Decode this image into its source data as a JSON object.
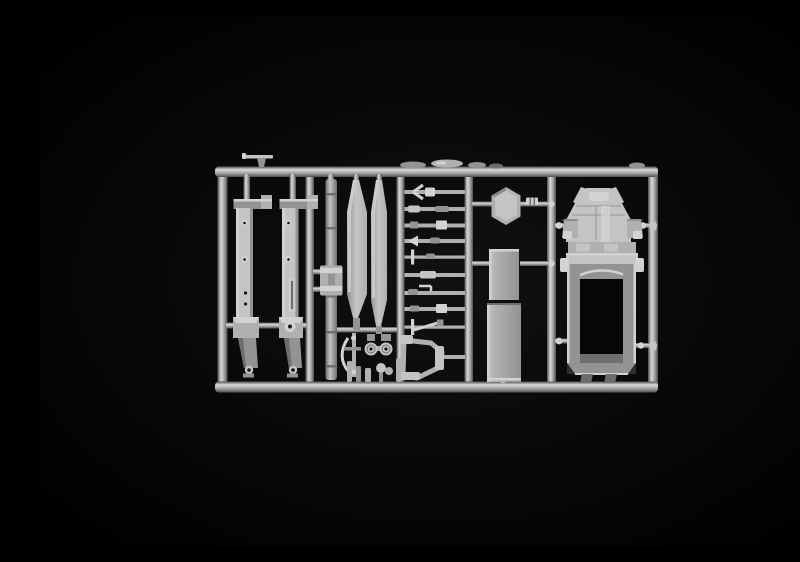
{
  "image": {
    "type": "photograph",
    "subject": "Plastic scale-model kit sprue photographed on a black background",
    "alt_text": "Light grey injection-moulded sprue (parts tree) of an unassembled military truck model kit: two chassis side rails, a segmented drive shaft, two long tapered side blades, a column of small axle and linkage parts, a hexagonal mount, two cargo-bed panels and a truck cab body shell, all attached to a rectangular runner frame on a black backdrop"
  },
  "palette": {
    "background": "#000000",
    "vignette": "#111111",
    "runner_light": "#d8d8d8",
    "runner_mid": "#a8a8a8",
    "runner_dark": "#4f4f4f",
    "part_bright": "#d2d2d2",
    "part_light": "#c4c4c4",
    "part_mid": "#b0b0b0",
    "part_dim": "#939393",
    "part_dark": "#6e6e6e",
    "shadow": "#2e2e2e",
    "hole": "#141414",
    "opening": "#060606"
  },
  "parts": {
    "runner_frame": "Sprue runner frame",
    "roof_part": "Small roof accessory lying on the top runner",
    "chassis_rail_left": "Chassis side rail (left)",
    "chassis_rail_right": "Chassis side rail (right)",
    "drive_shaft": "Segmented drive shaft with centre coupler",
    "blade_left": "Long tapered side blade (left)",
    "blade_right": "Long tapered side blade (right)",
    "bow_linkage": "Bow-shaped linkage",
    "wheel_pair": "Paired wheel hubs",
    "small_pegs": "Small cylindrical pegs",
    "linkage_ladder": "Column of small axle and linkage parts",
    "window_frame": "Open window frame",
    "hex_mount": "Hexagonal mount plate",
    "clip_part": "Small ribbed clip",
    "bed_panel_upper": "Cargo-bed panel (upper)",
    "bed_panel_lower": "Cargo-bed panel (lower)",
    "cab_shell": "Truck cab body shell"
  }
}
